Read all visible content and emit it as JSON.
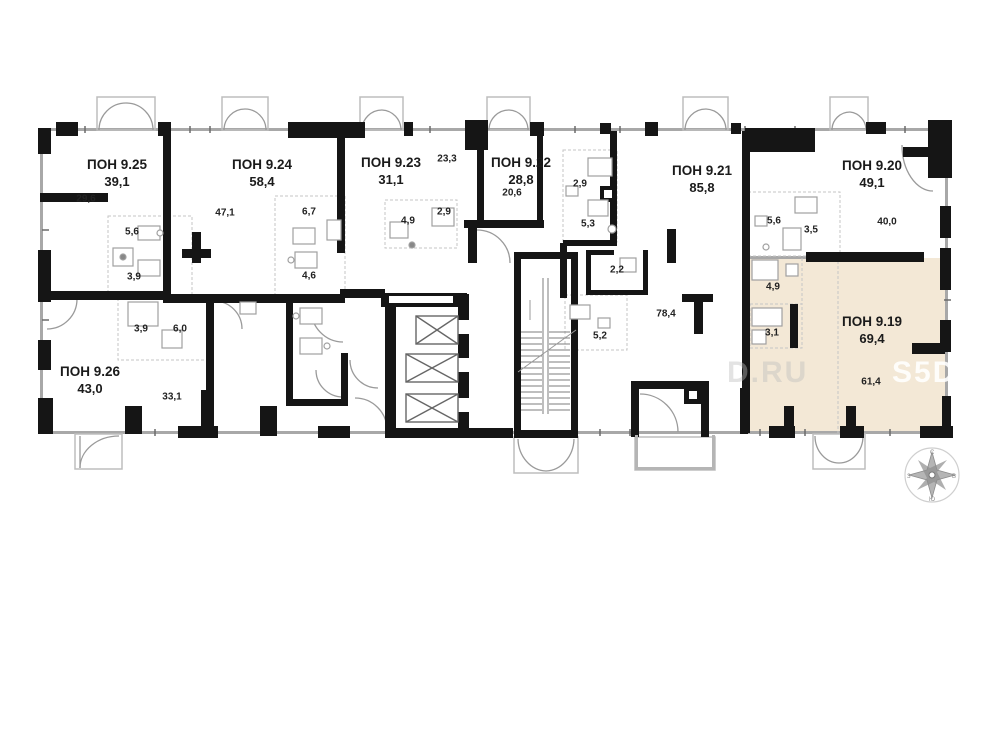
{
  "plan": {
    "highlight_color": "#f3e8d6",
    "rooms": [
      {
        "name": "ПОН 9.25",
        "area": "39,1"
      },
      {
        "name": "ПОН 9.24",
        "area": "58,4"
      },
      {
        "name": "ПОН 9.23",
        "area": "31,1"
      },
      {
        "name": "ПОН 9.22",
        "area": "28,8"
      },
      {
        "name": "ПОН 9.21",
        "area": "85,8"
      },
      {
        "name": "ПОН 9.20",
        "area": "49,1"
      },
      {
        "name": "ПОН 9.19",
        "area": "69,4",
        "highlighted": true
      },
      {
        "name": "ПОН 9.26",
        "area": "43,0"
      }
    ],
    "sub_labels": [
      "29,6",
      "5,6",
      "3,9",
      "47,1",
      "6,7",
      "4,6",
      "23,3",
      "2,9",
      "4,9",
      "20,6",
      "2,9",
      "5,3",
      "2,2",
      "5,2",
      "78,4",
      "5,6",
      "3,5",
      "40,0",
      "4,9",
      "3,1",
      "61,4",
      "3,9",
      "6,0",
      "33,1"
    ],
    "watermark": {
      "left_fragment": "D.RU",
      "right_fragment": "S5D"
    },
    "compass": {
      "n": "С",
      "e": "В",
      "s": "Ю",
      "w": "З"
    }
  }
}
